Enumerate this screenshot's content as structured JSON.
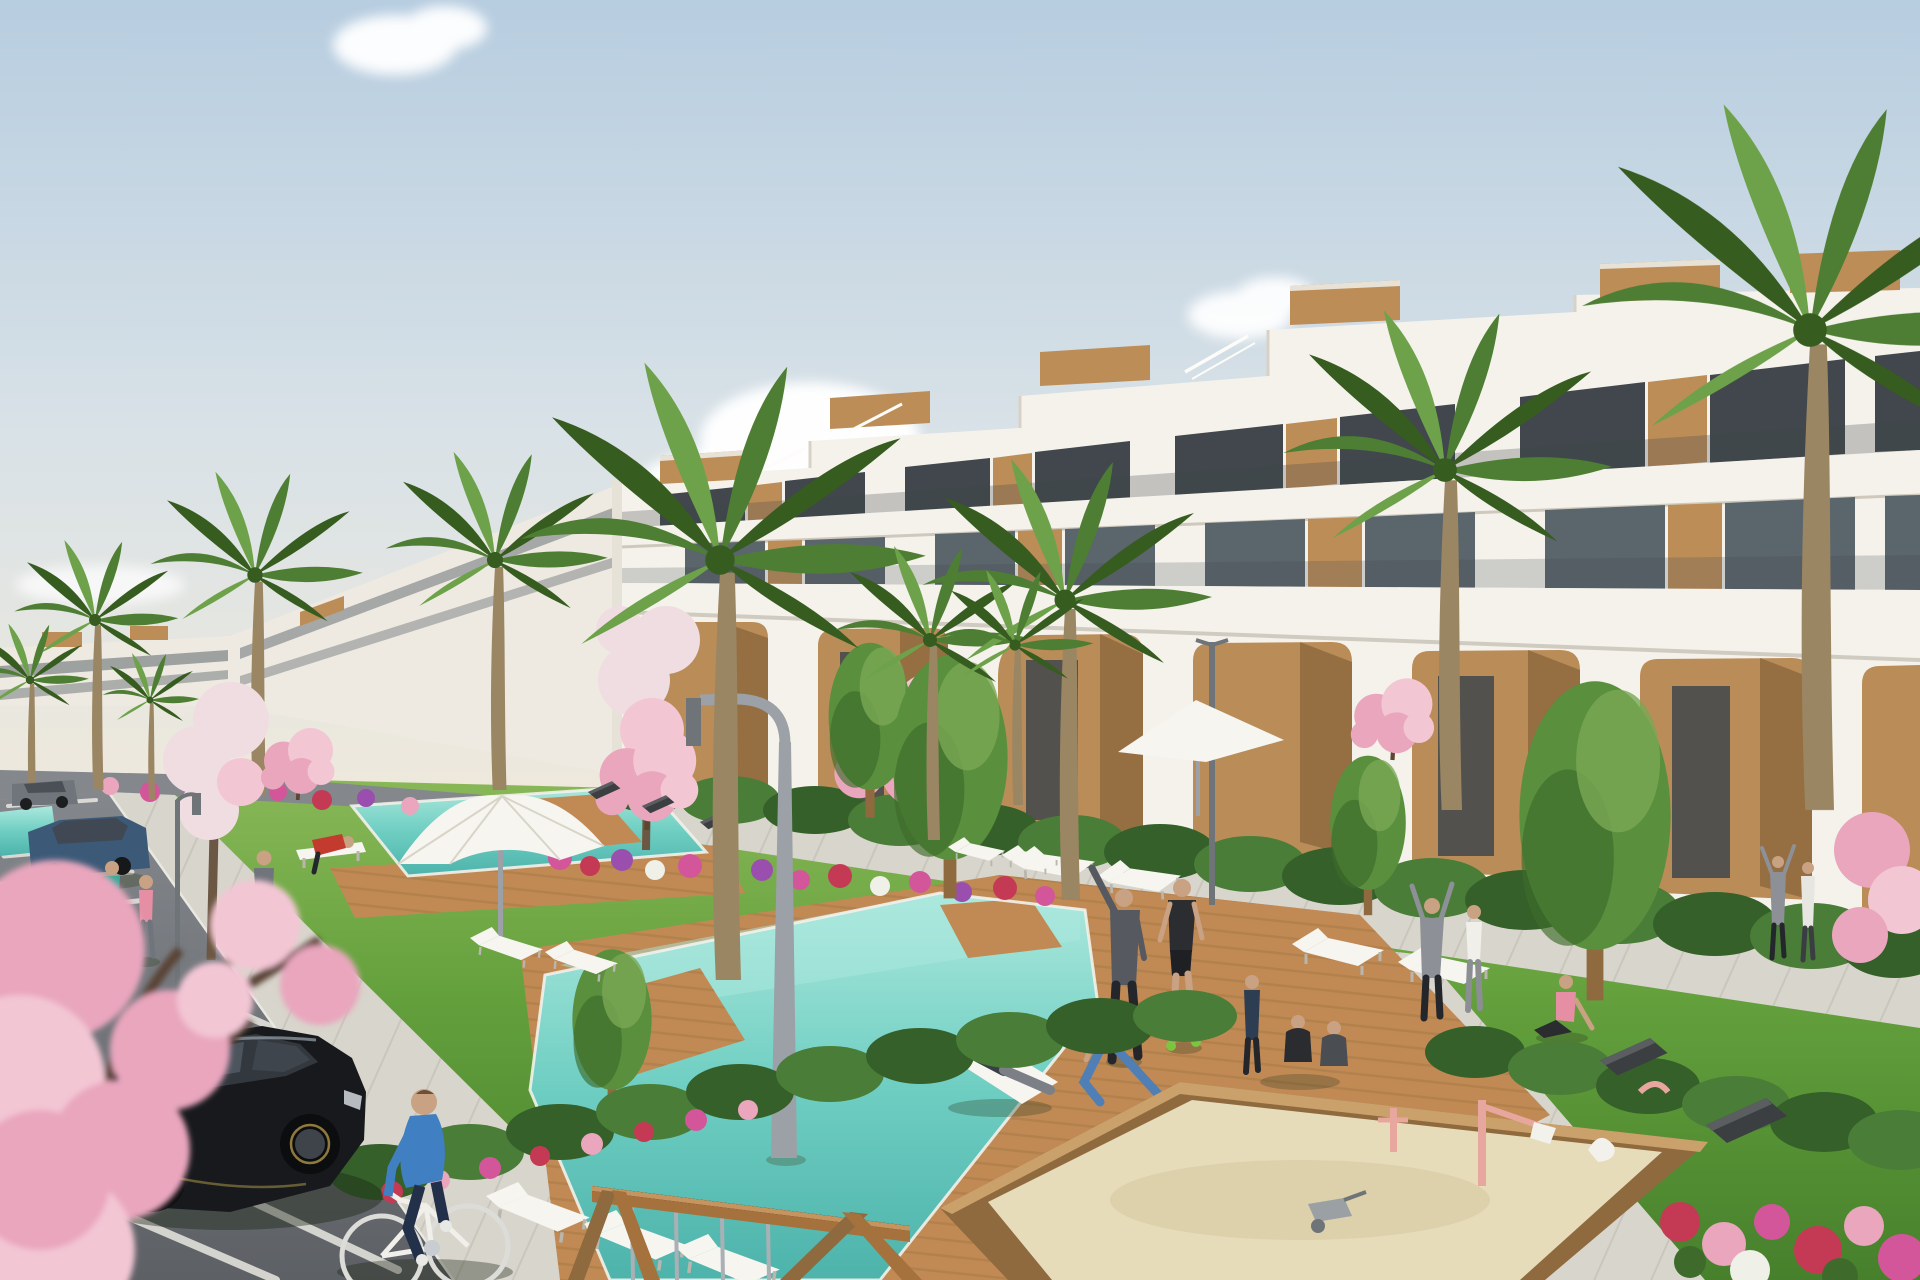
{
  "meta": {
    "domain": "Natural-Image",
    "description": "Sunny 3D architectural rendering of a modern terraced white apartment complex with wooden panel accents and glass balustrades, landscaped gardens, two turquoise swimming pools with timber decks, palm and cherry-blossom trees, flower beds, a parking area with cars, a cyclist, walkers, people exercising on the lawn, sun loungers, white parasols, street lamps, a children's sandbox playground and a wooden swing frame.",
    "setting": "residential resort complex, daytime, hazy blue sky with scattered clouds"
  },
  "colors": {
    "skyTop": "#b7cde0",
    "skyMid": "#d9e2e7",
    "skyGlow": "#efe9dc",
    "cloud": "#ffffff",
    "buildingWhite": "#f5f2ec",
    "buildingShade": "#e7e2d8",
    "buildingLeft": "#eeeae1",
    "parapetEdge": "#d8d2c6",
    "glassDark": "#41474c",
    "glassMid": "#5b656c",
    "glassSky": "#9fb0b8",
    "woodPanel": "#bd8d58",
    "woodDark": "#8f6a3e",
    "deckWood": "#c18a55",
    "deckLine": "#a87943",
    "arcadeWall": "#b98c58",
    "arcadeShadow": "#7d5a33",
    "grassLight": "#8ab858",
    "grass": "#63a03c",
    "grassDark": "#47802c",
    "hedge": "#35602a",
    "hedgeLight": "#4a7d38",
    "treeGreen": "#5a8f3d",
    "treeDark": "#3e6b2b",
    "treeLight": "#79a854",
    "palmGreen": "#4e7e33",
    "palmLight": "#6da24a",
    "palmDark": "#365c20",
    "trunkBrown": "#9b8663",
    "blossomPink": "#e9a6bd",
    "blossomLightPink": "#f3c6d4",
    "blossomPale": "#efdde2",
    "flowerRed": "#c43a54",
    "flowerMagenta": "#d4569a",
    "flowerPurple": "#9a4fae",
    "flowerWhite": "#eff0e8",
    "poolWater": "#6fcec2",
    "poolLight": "#ace8dd",
    "poolDeep": "#4db3ab",
    "pathGrey": "#d8d5cc",
    "pathShade": "#bcb9b0",
    "asphalt": "#84888d",
    "asphaltDark": "#5d6065",
    "lineWhite": "#e9e8e1",
    "kerb": "#cfccc2",
    "carBlack": "#17191c",
    "carBlackHl": "#454c55",
    "carBlue": "#3c5a78",
    "carGrey": "#70757c",
    "lampGrey": "#9ba1a6",
    "lampDark": "#6e7478",
    "sand": "#e7dcba",
    "sandShade": "#d4c69d",
    "benchDark": "#3c3f41",
    "furnitureWhite": "#f6f5f0",
    "skin": "#c9a183",
    "shirtBlue": "#3f7fc2",
    "shirtTeal": "#3aa999",
    "shirtPink": "#e68fa4",
    "shirtRed": "#c23b2e",
    "shirtGrey": "#70747c",
    "pantsDark": "#23262b",
    "metalGrey": "#aab0b4"
  },
  "inventory": {
    "buildings": [
      "stepped white apartment block with wooden rooftop boxes, dark glazing, wood slat panels and glass balcony rails",
      "ground-floor arcade with rounded arched openings and tan recessed walls",
      "distant lower apartment wing at left"
    ],
    "water_features": [
      "large central swimming pool with timber deck inserts",
      "smaller upper pool with deck",
      "pool sliver at far left"
    ],
    "vegetation": [
      "palm trees",
      "pink cherry-blossom trees",
      "pale white-blossom trees",
      "green poplar and olive trees",
      "clipped hedges",
      "flower beds in pink, red, purple and white",
      "lawns"
    ],
    "site_furniture": [
      "white sun loungers",
      "white parasols",
      "dark wedge benches",
      "arched street lamp",
      "straight street lamps"
    ],
    "vehicles": [
      "black hatchback in parking bay",
      "dark blue sedan",
      "grey car"
    ],
    "people": [
      "cyclist in blue on white bicycle",
      "two women walking on sidewalk",
      "man carrying a ball",
      "man in red shirt at white bench",
      "man reclining on a lounger by the pool",
      "man stretching with raised arm",
      "man in black sportswear",
      "woman lunging in blue leggings",
      "seated group on the lawn",
      "person with raised arms",
      "woman in white top",
      "woman in pink sitting on the path",
      "distant couple near the building"
    ],
    "playground": [
      "timber-framed sandbox with sand",
      "pink crane toy",
      "pink pump toy",
      "white swan rocker",
      "grey wheelbarrow",
      "wooden swing frame with thin metal posts"
    ]
  }
}
